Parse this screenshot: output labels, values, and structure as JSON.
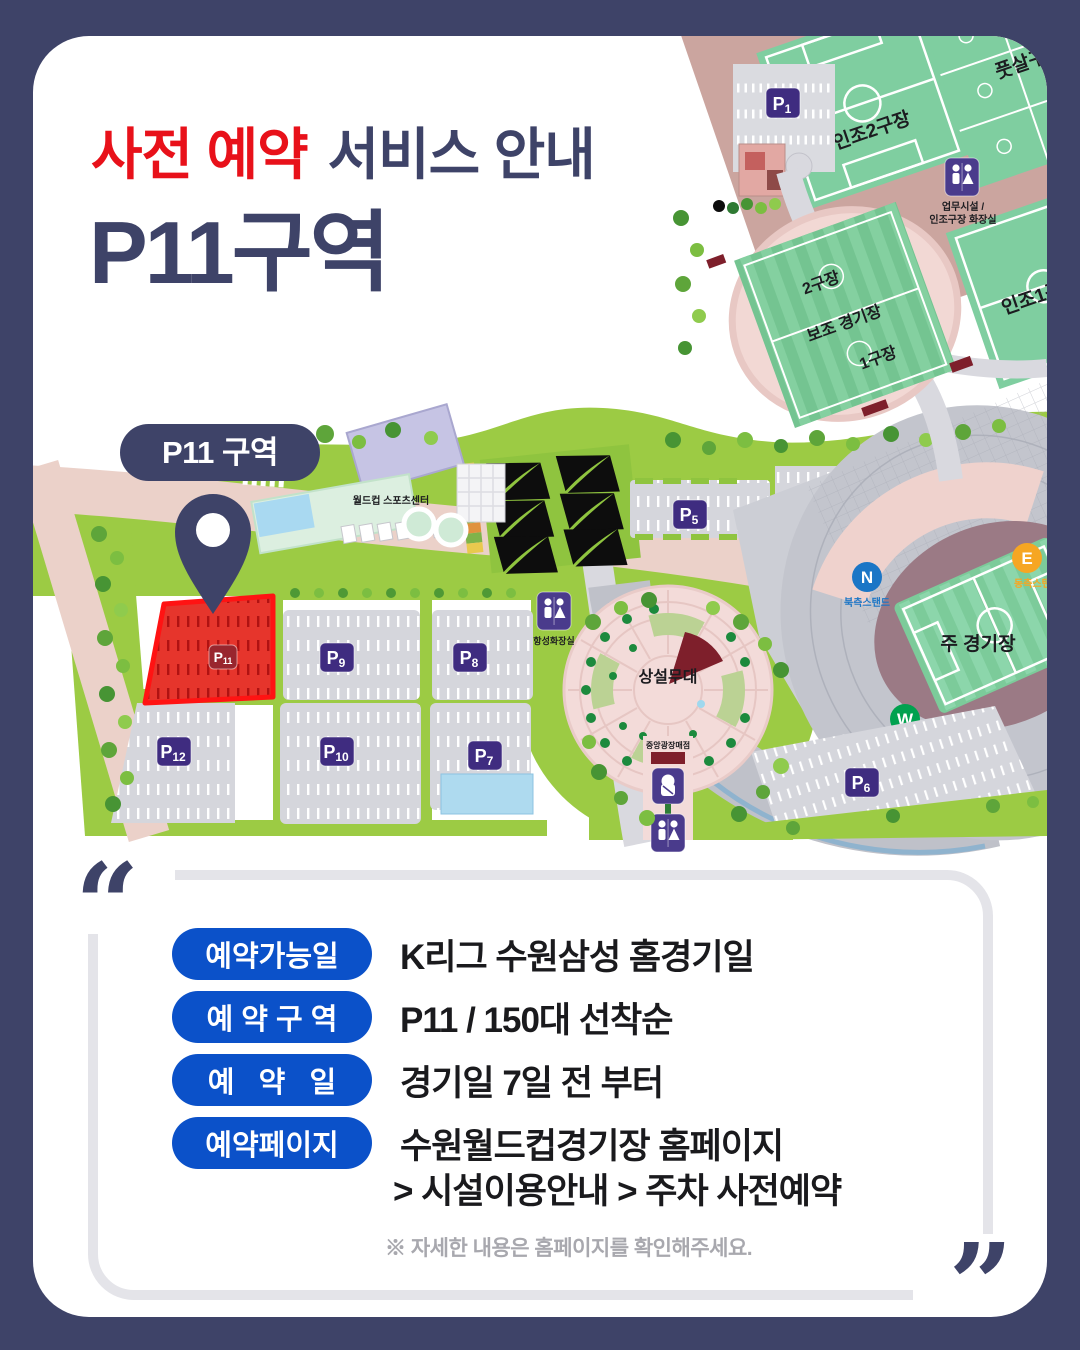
{
  "page": {
    "bg_color": "#3E4368",
    "accent_red": "#E8111A",
    "pill_blue": "#0B51C9"
  },
  "title": {
    "highlight": "사전 예약",
    "rest": "서비스 안내",
    "zone": "P11구역"
  },
  "map": {
    "callout": "P11 구역",
    "fields": {
      "injo2": "인조2구장",
      "futsal": "풋살구장",
      "injo1": "인조1구장",
      "f2": "2구장",
      "aux": "보조 경기장",
      "f1": "1구장",
      "main": "주 경기장"
    },
    "facilities": {
      "sports_center": "월드컵 스포츠센터",
      "stage": "상설무대",
      "snack": "중앙광장매점",
      "office_line1": "업무시설 /",
      "office_line2": "인조구장 화장실",
      "restroom_label": "항성화장실"
    },
    "stands": {
      "north": {
        "letter": "N",
        "label": "북측스탠드",
        "color": "#1B76C6"
      },
      "west": {
        "letter": "W",
        "label": "서측스탠드",
        "color": "#00A14F"
      },
      "east": {
        "letter": "E",
        "label": "동측스탠드",
        "color": "#F6A623"
      }
    },
    "badges": {
      "p1": {
        "letter": "P",
        "num": "1"
      },
      "p5": {
        "letter": "P",
        "num": "5"
      },
      "p6": {
        "letter": "P",
        "num": "6"
      },
      "p7": {
        "letter": "P",
        "num": "7"
      },
      "p8": {
        "letter": "P",
        "num": "8"
      },
      "p9": {
        "letter": "P",
        "num": "9"
      },
      "p10": {
        "letter": "P",
        "num": "10"
      },
      "p11": {
        "letter": "P",
        "num": "11"
      },
      "p12": {
        "letter": "P",
        "num": "12"
      }
    }
  },
  "info": {
    "rows": [
      {
        "label": "예약가능일",
        "value": "K리그 수원삼성 홈경기일"
      },
      {
        "label": "예 약 구 역",
        "value": "P11 / 150대 선착순"
      },
      {
        "label": "예   약   일",
        "value": "경기일 7일 전 부터"
      },
      {
        "label": "예약페이지",
        "value": "수원월드컵경기장 홈페이지",
        "value2": "> 시설이용안내 > 주차 사전예약"
      }
    ],
    "note": "※ 자세한 내용은 홈페이지를 확인해주세요.",
    "quote_open": "“",
    "quote_close": "”"
  }
}
